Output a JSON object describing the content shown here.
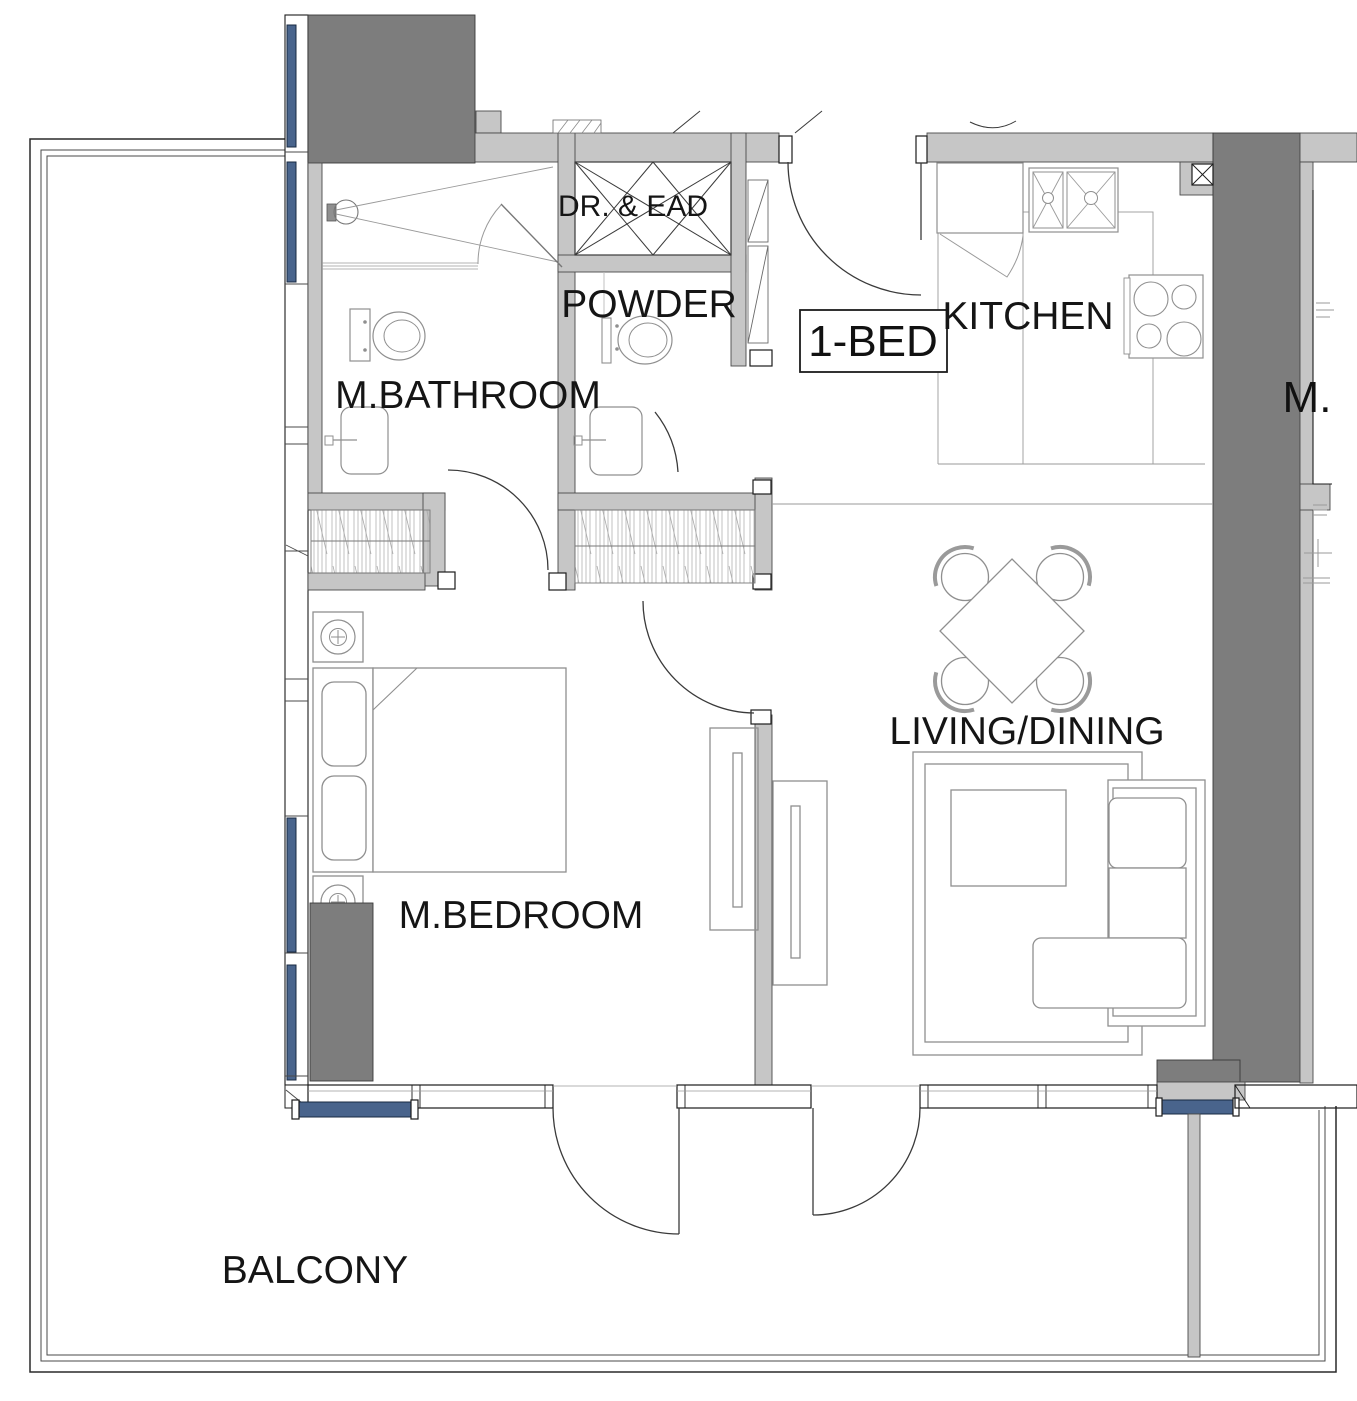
{
  "plan": {
    "type": "apartment-floor-plan",
    "unit_type": "1-BED",
    "labels": [
      {
        "id": "dr-ead",
        "text": "DR. & EAD"
      },
      {
        "id": "powder",
        "text": "POWDER"
      },
      {
        "id": "m-bathroom",
        "text": "M.BATHROOM"
      },
      {
        "id": "unit",
        "text": "1-BED"
      },
      {
        "id": "kitchen",
        "text": "KITCHEN"
      },
      {
        "id": "living-dining",
        "text": "LIVING/DINING"
      },
      {
        "id": "m-bedroom",
        "text": "M.BEDROOM"
      },
      {
        "id": "balcony",
        "text": "BALCONY"
      },
      {
        "id": "adjacent-unit-partial",
        "text": "M."
      }
    ],
    "colors": {
      "wall_fill": "#c6c6c6",
      "structural_dark": "#7d7d7d",
      "glazing_blue": "#49648c",
      "line": "#3a3a3a",
      "furniture_line": "#8f8f8f",
      "text": "#151515",
      "background": "#ffffff"
    }
  }
}
